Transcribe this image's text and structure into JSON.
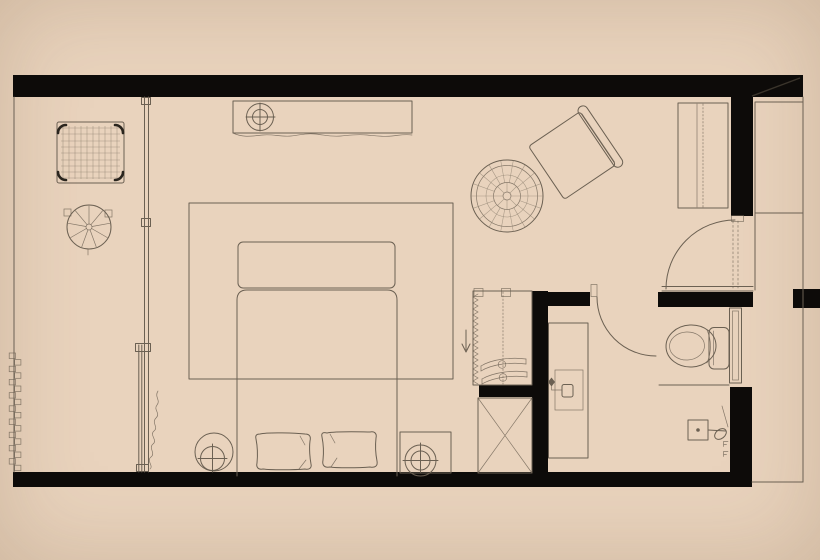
{
  "app": {
    "title": "Hotel guest room floor plan"
  },
  "canvas": {
    "width": 820,
    "height": 560
  },
  "colors": {
    "background": "#e9d3bd",
    "wall": "#0d0b09",
    "line": "#6b6052",
    "line_soft": "#8f8171",
    "accent_dark": "#2a251e"
  },
  "plan": {
    "rooms": {
      "balcony": {
        "label": "balcony-terrace-zone"
      },
      "bedroom": {
        "label": "bedroom-zone"
      },
      "dressing": {
        "label": "dressing-area"
      },
      "bathroom": {
        "label": "bathroom"
      },
      "entry": {
        "label": "entry-vestibule"
      }
    },
    "furniture": {
      "wicker_chair": {
        "label": "woven-wicker-armchair"
      },
      "round_table": {
        "label": "round-side-table"
      },
      "console": {
        "label": "console-desk-with-lamp"
      },
      "rug": {
        "label": "area-rug"
      },
      "bench": {
        "label": "foot-of-bed-bench"
      },
      "bed": {
        "label": "double-bed-with-pillows"
      },
      "lamp_left": {
        "label": "bedside-lamp-on-round-table"
      },
      "nightstand": {
        "label": "square-nightstand-with-lamp"
      },
      "pouf": {
        "label": "round-woven-pouf"
      },
      "lounge_chair": {
        "label": "rotated-lounge-chair"
      },
      "wardrobe": {
        "label": "built-in-wardrobe"
      },
      "closet": {
        "label": "open-closet-with-hangers"
      },
      "luggage_shaft": {
        "label": "crossed-box-luggage-shaft"
      },
      "vanity": {
        "label": "bathroom-vanity-with-sink"
      },
      "toilet": {
        "label": "toilet"
      },
      "shower": {
        "label": "shower-set"
      },
      "shower_screen": {
        "label": "shower-glass-screen"
      },
      "window_wall": {
        "label": "sliding-window-partition"
      },
      "curtain": {
        "label": "curtain-squiggle"
      },
      "entry_door": {
        "label": "entry-door-swing"
      },
      "bath_door": {
        "label": "bathroom-door-swing"
      }
    }
  }
}
